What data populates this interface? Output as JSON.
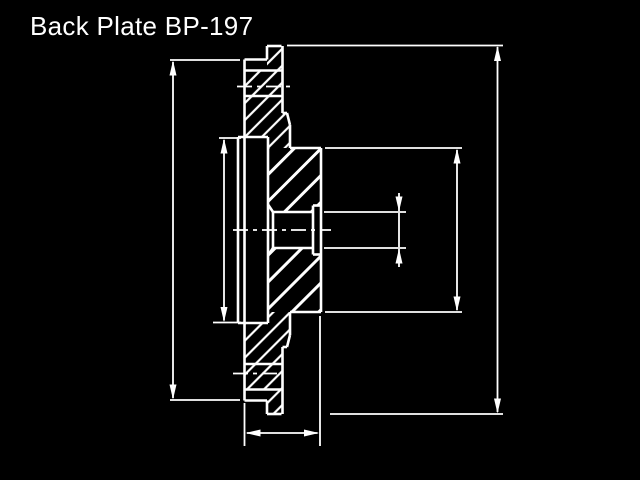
{
  "title": "Back Plate BP-197",
  "colors": {
    "background": "#000000",
    "line": "#ffffff"
  },
  "drawing": {
    "canvas": {
      "width": 640,
      "height": 480
    },
    "outline_segments": [
      [
        267,
        46,
        281.5,
        46
      ],
      [
        244.5,
        59.5,
        267,
        59.5
      ],
      [
        244.5,
        70.5,
        282.5,
        70.5
      ],
      [
        244.5,
        96,
        283,
        96
      ],
      [
        238,
        137,
        268,
        137
      ],
      [
        290,
        148,
        321,
        148
      ],
      [
        313,
        205.5,
        321,
        205.5
      ],
      [
        273,
        212,
        313,
        212
      ],
      [
        273,
        248,
        313,
        248
      ],
      [
        313,
        254.5,
        321,
        254.5
      ],
      [
        290,
        312,
        321,
        312
      ],
      [
        238,
        323,
        268,
        323
      ],
      [
        244.5,
        364,
        283,
        364
      ],
      [
        244.5,
        389.5,
        282.5,
        389.5
      ],
      [
        244.5,
        400.5,
        267,
        400.5
      ],
      [
        267,
        414,
        281.5,
        414
      ],
      [
        244.5,
        59.5,
        244.5,
        400.5
      ],
      [
        238,
        137,
        238,
        323
      ],
      [
        268,
        137,
        268,
        323
      ],
      [
        267,
        46,
        267,
        59.5
      ],
      [
        267,
        400.5,
        267,
        414
      ],
      [
        282.5,
        46,
        282.5,
        113
      ],
      [
        282.5,
        347,
        282.5,
        414
      ],
      [
        282.5,
        113,
        287,
        113
      ],
      [
        287,
        113,
        290,
        125
      ],
      [
        290,
        125,
        290,
        148
      ],
      [
        282.5,
        347,
        287,
        347
      ],
      [
        287,
        347,
        290,
        335
      ],
      [
        290,
        312,
        290,
        335
      ],
      [
        321,
        148,
        321,
        312
      ],
      [
        313,
        205.5,
        313,
        254.5
      ],
      [
        273,
        212,
        273,
        248
      ],
      [
        268,
        204.5,
        273,
        212
      ],
      [
        268,
        255.5,
        273,
        248
      ]
    ],
    "hatch_fine_regions": [
      "267,46 281.5,46 281.5,70.5 267,70.5",
      "244.5,70.5 282.5,70.5 282.5,96 244.5,96",
      "244.5,96 282.5,96 282.5,113 287,113 290,125 290,148 268,148 268,137 244.5,137",
      "267,389.5 281.5,389.5 281.5,414 267,414",
      "244.5,364 282.5,364 282.5,389.5 244.5,389.5",
      "244.5,323 268,323 268,312 290,312 290,335 287,347 282.5,347 282.5,364 244.5,364"
    ],
    "hatch_coarse_regions": [
      "268,148 321,148 321,205.5 313,205.5 313,212 273,212 268,204.5",
      "268,255.5 273,248 313,248 313,254.5 321,254.5 321,312 268,312"
    ],
    "centerlines": [
      [
        233,
        230,
        331,
        230
      ],
      [
        237,
        86.5,
        291,
        86.5
      ],
      [
        233,
        373.5,
        280,
        373.5
      ]
    ],
    "extension_lines": [
      [
        170,
        60,
        240,
        60
      ],
      [
        170,
        400,
        240,
        400
      ],
      [
        219,
        138,
        241,
        138
      ],
      [
        213,
        322.5,
        241,
        322.5
      ],
      [
        287,
        45.5,
        503,
        45.5
      ],
      [
        330,
        414,
        503,
        414
      ],
      [
        325,
        148,
        462,
        148
      ],
      [
        325,
        312,
        462,
        312
      ],
      [
        324,
        212,
        406,
        212
      ],
      [
        324,
        248,
        406,
        248
      ],
      [
        244.5,
        403,
        244.5,
        446
      ],
      [
        320,
        316,
        320,
        446
      ]
    ],
    "dimension_lines": [
      [
        173,
        62,
        173,
        398
      ],
      [
        224,
        140,
        224,
        320.5
      ],
      [
        497.5,
        47,
        497.5,
        412
      ],
      [
        457,
        150,
        457,
        310
      ],
      [
        399,
        193,
        399,
        211
      ],
      [
        399,
        213,
        399,
        247
      ],
      [
        399,
        249,
        399,
        267
      ],
      [
        247,
        433,
        317.5,
        433
      ]
    ],
    "arrowheads": [
      {
        "x": 173,
        "y": 60.5,
        "dir": "up"
      },
      {
        "x": 173,
        "y": 399.5,
        "dir": "down"
      },
      {
        "x": 224,
        "y": 138.5,
        "dir": "up"
      },
      {
        "x": 224,
        "y": 322,
        "dir": "down"
      },
      {
        "x": 497.5,
        "y": 46,
        "dir": "up"
      },
      {
        "x": 497.5,
        "y": 413.5,
        "dir": "down"
      },
      {
        "x": 457,
        "y": 148.5,
        "dir": "up"
      },
      {
        "x": 457,
        "y": 311.5,
        "dir": "down"
      },
      {
        "x": 399,
        "y": 211.5,
        "dir": "down"
      },
      {
        "x": 399,
        "y": 248.5,
        "dir": "up"
      },
      {
        "x": 245.5,
        "y": 433,
        "dir": "left"
      },
      {
        "x": 319,
        "y": 433,
        "dir": "right"
      }
    ]
  }
}
